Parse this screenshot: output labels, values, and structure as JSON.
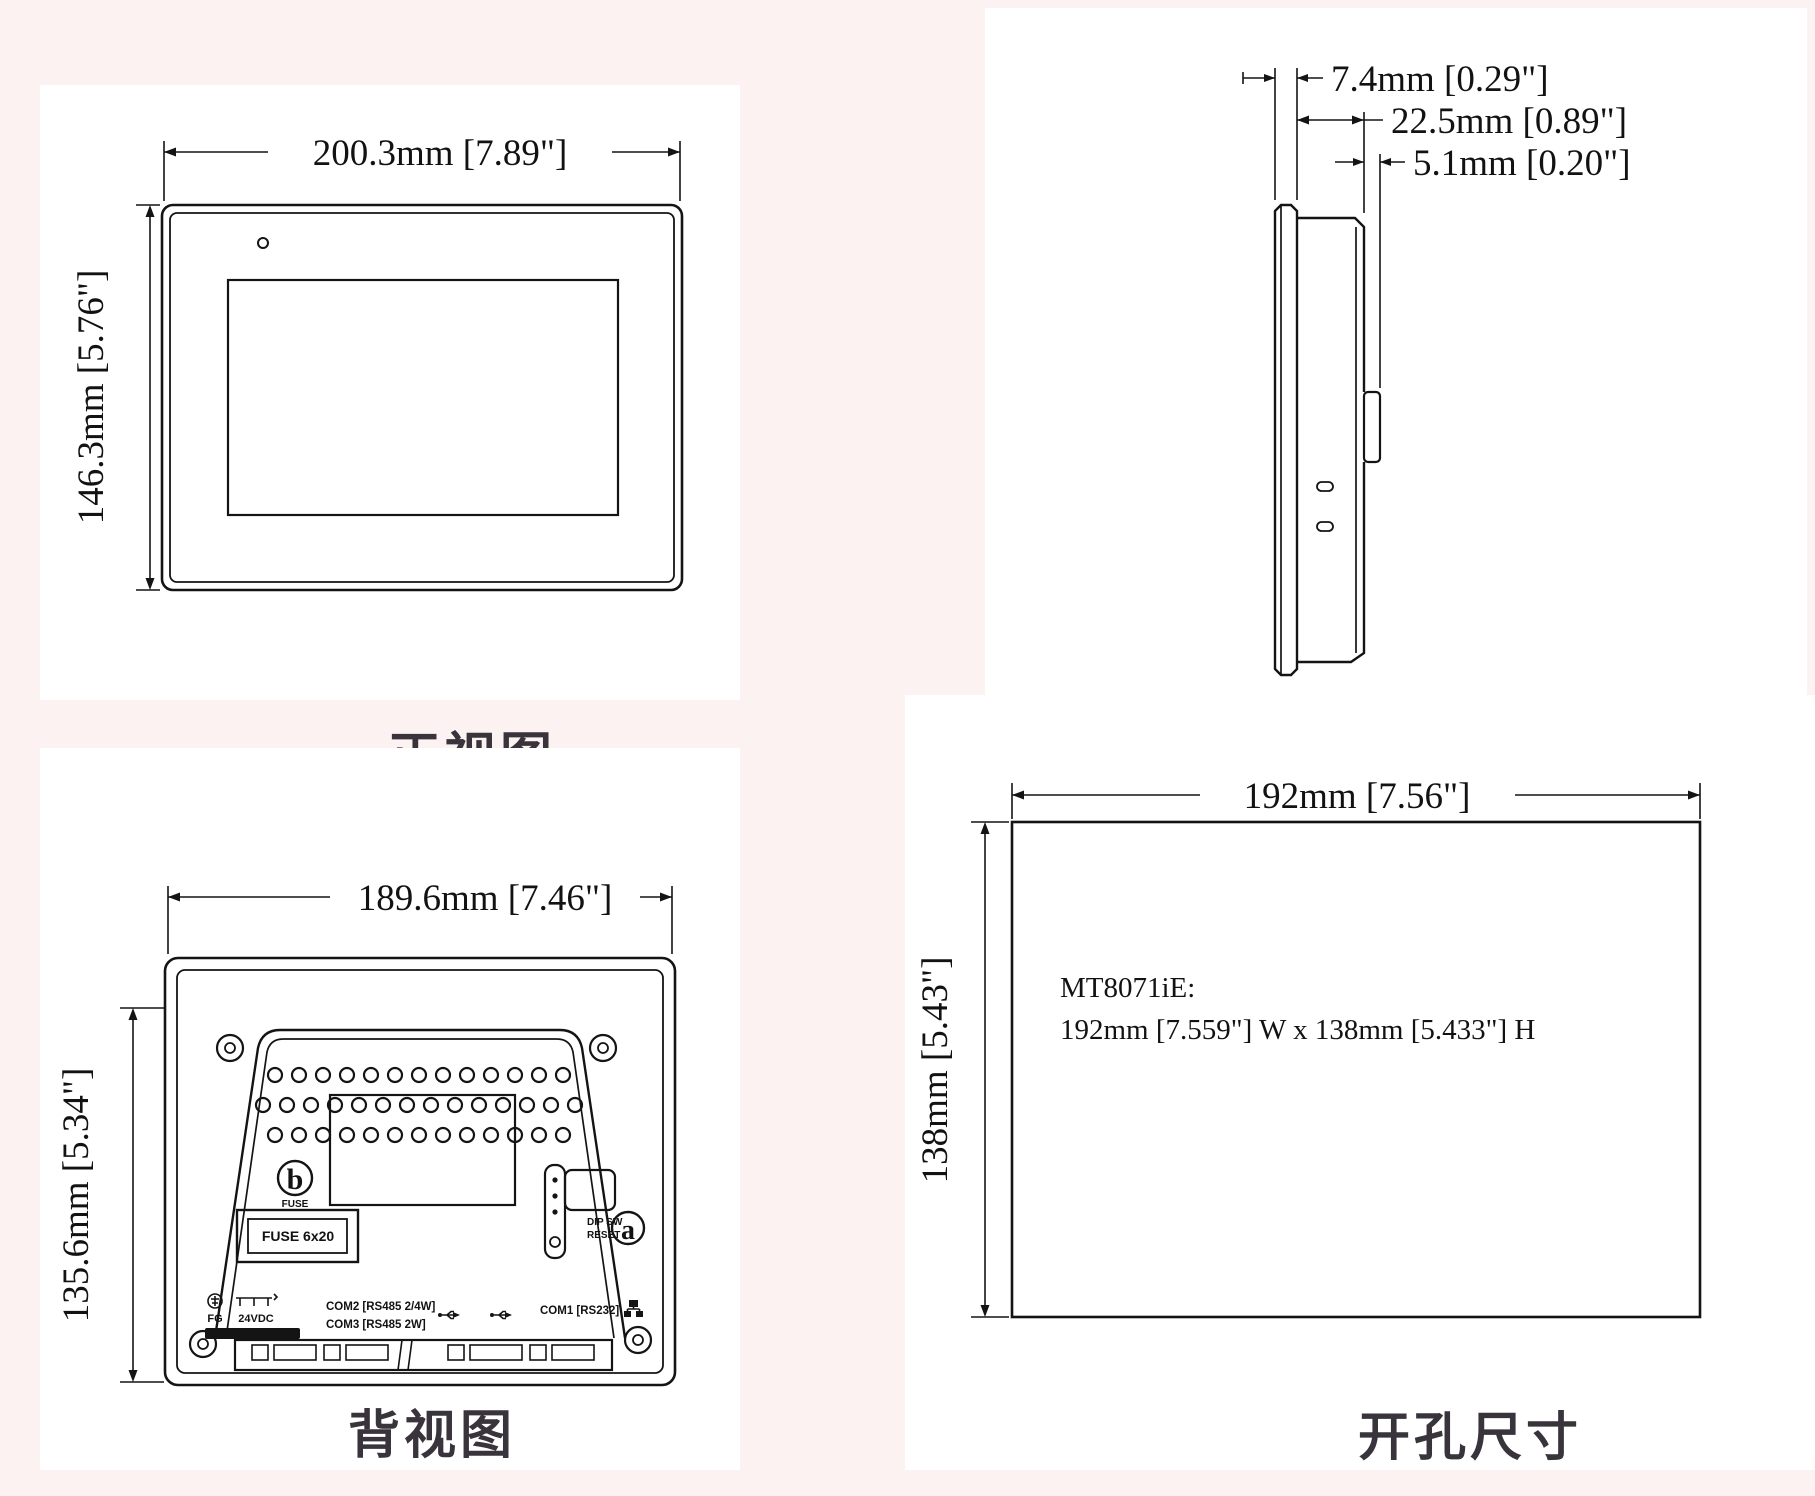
{
  "page": {
    "background_color": "#fcf2f1",
    "panel_color": "#ffffff",
    "line_color": "#141414",
    "caption_color": "#39333c"
  },
  "views": {
    "front": {
      "caption": "正视图",
      "width_dim": "200.3mm [7.89\"]",
      "height_dim": "146.3mm [5.76\"]"
    },
    "side": {
      "caption": "侧视图",
      "dims": [
        "7.4mm [0.29\"]",
        "22.5mm [0.89\"]",
        "5.1mm [0.20\"]"
      ]
    },
    "back": {
      "caption": "背视图",
      "width_dim": "189.6mm [7.46\"]",
      "height_dim": "135.6mm [5.34\"]",
      "marker_b": "b",
      "marker_b_sub": "FUSE",
      "fuse_label": "FUSE 6x20",
      "marker_a": "a",
      "dip_label_1": "DIP SW",
      "dip_label_2": "RESET",
      "ports": {
        "power_fg": "FG",
        "power_v": "24VDC",
        "com2": "COM2 [RS485 2/4W]",
        "com3": "COM3 [RS485 2W]",
        "com1": "COM1 [RS232]"
      },
      "icons": {
        "usb": "usb-icon",
        "ethernet": "ethernet-icon",
        "ground": "protective-earth-icon"
      }
    },
    "cutout": {
      "caption": "开孔尺寸",
      "width_dim": "192mm [7.56\"]",
      "height_dim": "138mm [5.43\"]",
      "note_line1": "MT8071iE:",
      "note_line2": "192mm [7.559\"] W x 138mm [5.433\"] H"
    }
  }
}
